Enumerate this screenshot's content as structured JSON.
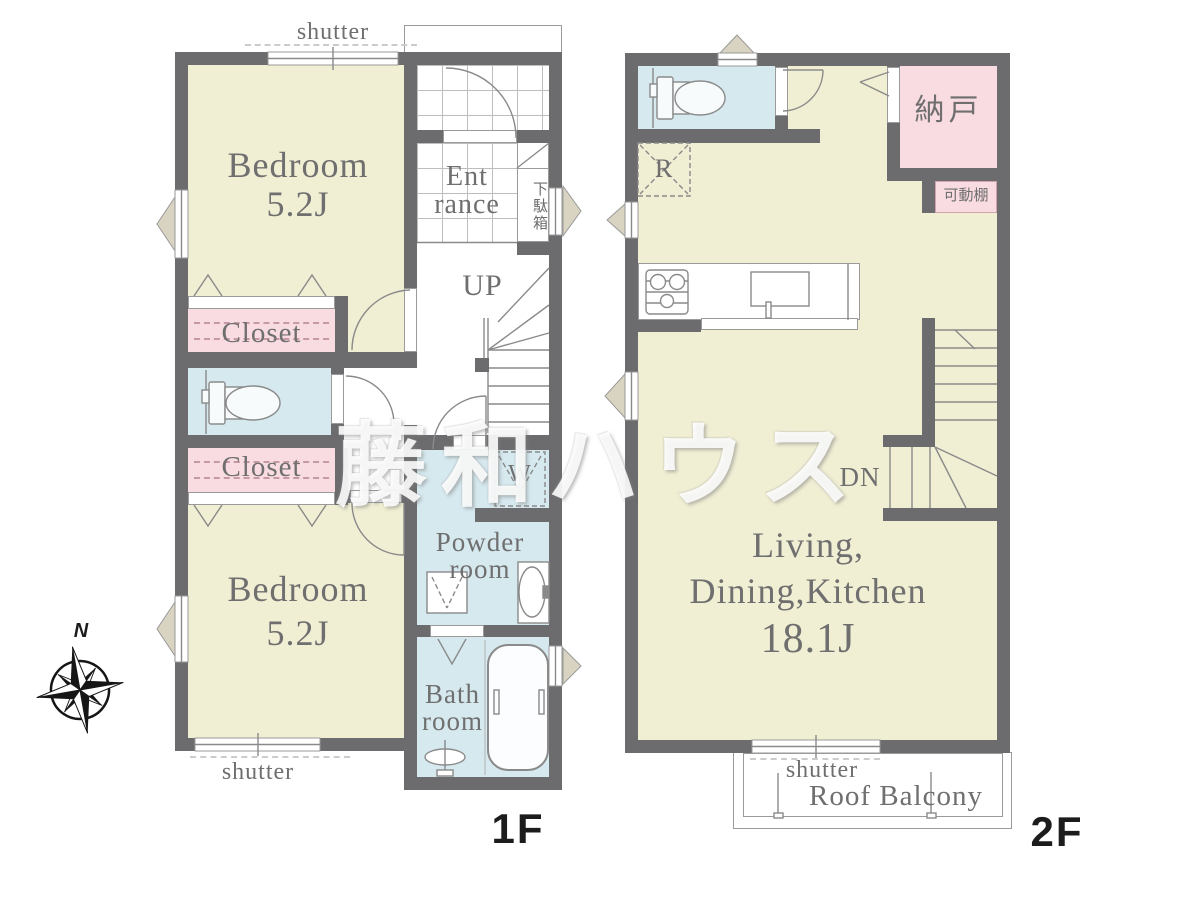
{
  "watermark_text": "藤和ハウス",
  "compass": {
    "north": "N"
  },
  "floor1": {
    "label": "1F",
    "bedroom1": {
      "name": "Bedroom",
      "area": "5.2J"
    },
    "bedroom2": {
      "name": "Bedroom",
      "area": "5.2J"
    },
    "entrance": {
      "line1": "Ent",
      "line2": "rance"
    },
    "shoe_box": "下駄箱",
    "closet1": "Closet",
    "closet2": "Closet",
    "stairs": "UP",
    "washer_symbol": "W",
    "powder": {
      "line1": "Powder",
      "line2": "room"
    },
    "bath": {
      "line1": "Bath",
      "line2": "room"
    },
    "shutter_top": "shutter",
    "shutter_bottom": "shutter"
  },
  "floor2": {
    "label": "2F",
    "ldk": {
      "line1": "Living,",
      "line2": "Dining,Kitchen",
      "area": "18.1J"
    },
    "storage": "納戸",
    "movable_shelf": "可動棚",
    "fridge_symbol": "R",
    "stairs": "DN",
    "shutter": "shutter",
    "balcony": "Roof Balcony"
  },
  "colors": {
    "wall": "#6c6c6e",
    "room_floor": "#f0eed3",
    "wet_area": "#d6e9ef",
    "closet": "#f9dbe2",
    "window_marker": "#d9d3c2",
    "label_text": "#6f6f6f"
  }
}
